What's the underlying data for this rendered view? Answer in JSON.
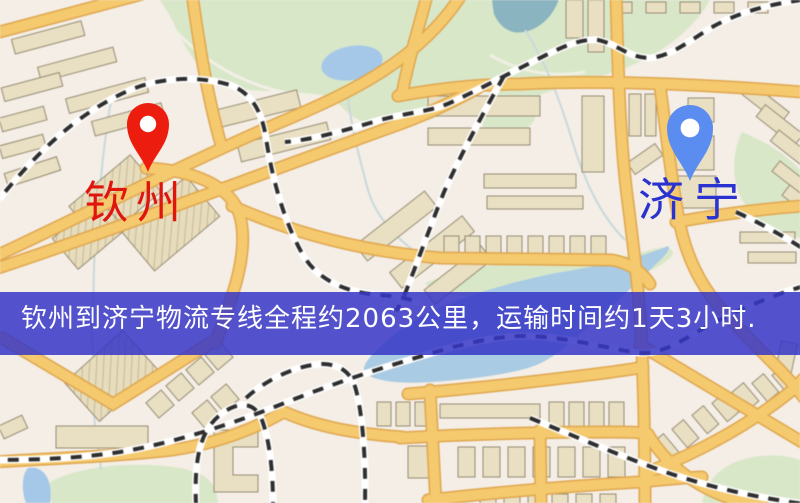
{
  "markers": {
    "origin": {
      "label": "钦州",
      "pin_color": "#ec1c0e",
      "label_color": "#e0150c"
    },
    "destination": {
      "label": "济宁",
      "pin_color": "#5b8cf0",
      "label_color": "#2a33cf"
    }
  },
  "banner": {
    "text": "钦州到济宁物流专线全程约2063公里，运输时间约1天3小时.",
    "background": "#3636c7",
    "text_color": "#ffffff"
  },
  "map": {
    "background": "#f4eee6",
    "road_fill": "#f5c96e",
    "road_edge": "#dfa64e",
    "building_fill": "#e9dfc2",
    "building_edge": "#968b74",
    "park_fill": "#d9e7c9",
    "lake_fill": "#a5c8e8",
    "stream_fill": "#8ab4c0",
    "railway_dash": "#2e2e2e",
    "railway_casing": "#ffffff"
  }
}
